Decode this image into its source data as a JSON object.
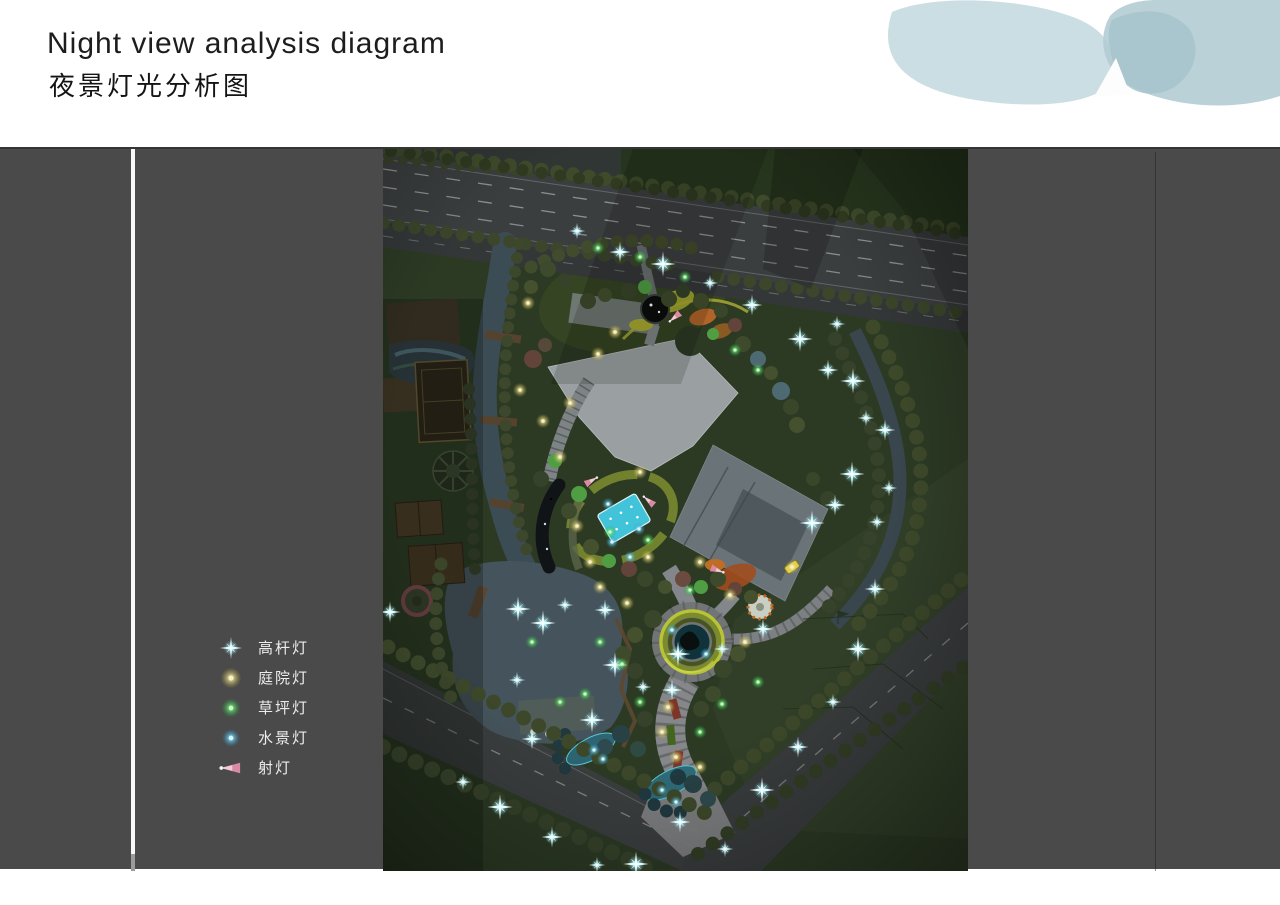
{
  "page": {
    "title_en": "Night view analysis diagram",
    "title_zh": "夜景灯光分析图"
  },
  "legend": {
    "items": [
      {
        "id": "high_pole",
        "label": "高杆灯",
        "symbol": "star",
        "color": "#e8fdff"
      },
      {
        "id": "courtyard",
        "label": "庭院灯",
        "symbol": "dot",
        "color": "#efe3a0"
      },
      {
        "id": "lawn",
        "label": "草坪灯",
        "symbol": "dot",
        "color": "#46d551"
      },
      {
        "id": "water",
        "label": "水景灯",
        "symbol": "dot",
        "color": "#4fd2ec"
      },
      {
        "id": "spot",
        "label": "射灯",
        "symbol": "wedge",
        "color": "#e29ab2"
      }
    ]
  },
  "map": {
    "colors": {
      "panel_gray": "#4a4a4b",
      "site_green": "#2c3a24",
      "field_green": "#26351d",
      "road_gray": "#3b3e3f",
      "water_blue": "#45545c",
      "pool_cyan": "#41c4da",
      "building_gray": "#9aa0a2"
    },
    "lights": {
      "high_pole": [
        [
          194,
          82
        ],
        [
          237,
          103
        ],
        [
          280,
          115
        ],
        [
          327,
          134
        ],
        [
          369,
          156
        ],
        [
          417,
          190
        ],
        [
          454,
          175
        ],
        [
          445,
          221
        ],
        [
          470,
          232
        ],
        [
          483,
          269
        ],
        [
          502,
          281
        ],
        [
          469,
          325
        ],
        [
          506,
          339
        ],
        [
          452,
          356
        ],
        [
          429,
          374
        ],
        [
          494,
          373
        ],
        [
          492,
          440
        ],
        [
          475,
          500
        ],
        [
          450,
          553
        ],
        [
          415,
          598
        ],
        [
          379,
          641
        ],
        [
          342,
          700
        ],
        [
          297,
          673
        ],
        [
          253,
          715
        ],
        [
          214,
          716
        ],
        [
          169,
          688
        ],
        [
          117,
          658
        ],
        [
          80,
          633
        ],
        [
          7,
          463
        ],
        [
          135,
          460
        ],
        [
          182,
          456
        ],
        [
          222,
          461
        ],
        [
          232,
          516
        ],
        [
          134,
          531
        ],
        [
          149,
          590
        ],
        [
          209,
          571
        ],
        [
          260,
          538
        ],
        [
          289,
          541
        ],
        [
          295,
          505
        ],
        [
          339,
          500
        ],
        [
          380,
          480
        ],
        [
          160,
          474
        ]
      ],
      "courtyard": [
        [
          145,
          154
        ],
        [
          137,
          241
        ],
        [
          160,
          272
        ],
        [
          177,
          308
        ],
        [
          187,
          254
        ],
        [
          194,
          377
        ],
        [
          207,
          413
        ],
        [
          217,
          438
        ],
        [
          244,
          454
        ],
        [
          257,
          323
        ],
        [
          317,
          413
        ],
        [
          347,
          446
        ],
        [
          362,
          493
        ],
        [
          409,
          418
        ],
        [
          285,
          558
        ],
        [
          279,
          583
        ],
        [
          293,
          608
        ],
        [
          317,
          618
        ],
        [
          215,
          205
        ],
        [
          232,
          183
        ],
        [
          265,
          408
        ]
      ],
      "lawn": [
        [
          215,
          99
        ],
        [
          257,
          108
        ],
        [
          302,
          128
        ],
        [
          352,
          201
        ],
        [
          375,
          221
        ],
        [
          227,
          383
        ],
        [
          265,
          391
        ],
        [
          307,
          441
        ],
        [
          217,
          493
        ],
        [
          239,
          515
        ],
        [
          202,
          545
        ],
        [
          257,
          553
        ],
        [
          317,
          583
        ],
        [
          339,
          555
        ],
        [
          375,
          533
        ],
        [
          149,
          493
        ],
        [
          177,
          553
        ]
      ],
      "water": [
        [
          229,
          393
        ],
        [
          247,
          408
        ],
        [
          289,
          481
        ],
        [
          323,
          505
        ],
        [
          211,
          601
        ],
        [
          220,
          610
        ],
        [
          279,
          641
        ],
        [
          293,
          653
        ],
        [
          225,
          355
        ],
        [
          256,
          380
        ]
      ],
      "spot": [
        [
          266,
          352,
          40
        ],
        [
          334,
          421,
          200
        ],
        [
          292,
          168,
          320
        ],
        [
          208,
          332,
          150
        ]
      ]
    }
  }
}
